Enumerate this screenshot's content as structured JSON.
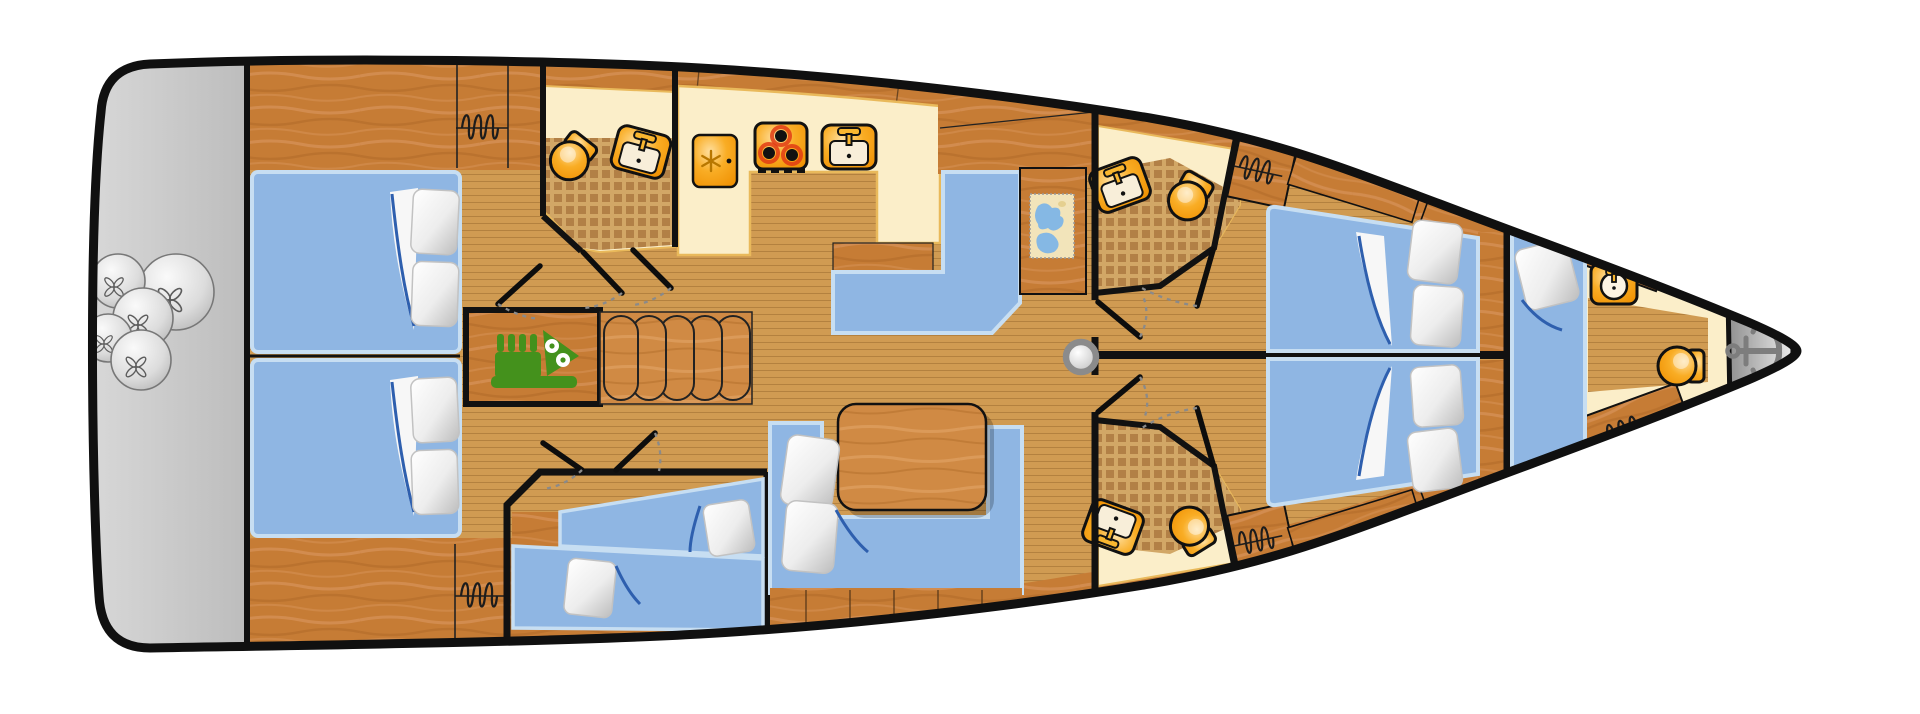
{
  "diagram": {
    "type": "yacht-interior-deck-plan",
    "orientation": "bow-right",
    "text_labels": []
  },
  "colors": {
    "background": "#ffffff",
    "hull_outline": "#101010",
    "platform_gray": "#c9c9c9",
    "wood_furniture": "#c67c35",
    "floor_plank": "#d09b52",
    "counter_cream": "#fbeec9",
    "bed_blue": "#8fb6e3",
    "fixture_orange": "#f6a41f",
    "engine_green": "#44911c",
    "anchor_gray": "#7d7d7d",
    "tile_checker": "#b28046"
  },
  "rooms": [
    {
      "id": "stern-platform",
      "name": "Stern swim platform",
      "fixtures": [
        "fender-ball x5"
      ]
    },
    {
      "id": "aft-cabin-port",
      "name": "Aft double cabin port",
      "fixtures": [
        "double-bed",
        "pillow x2",
        "wardrobe-coil"
      ]
    },
    {
      "id": "aft-cabin-starboard",
      "name": "Aft double cabin starboard",
      "fixtures": [
        "double-bed",
        "pillow x2",
        "wardrobe-coil"
      ]
    },
    {
      "id": "aft-head",
      "name": "Aft bathroom",
      "fixtures": [
        "toilet",
        "sink"
      ]
    },
    {
      "id": "galley",
      "name": "Galley",
      "fixtures": [
        "fridge",
        "stove-3-burner",
        "sink"
      ]
    },
    {
      "id": "engine-room",
      "name": "Engine compartment",
      "fixtures": [
        "engine"
      ]
    },
    {
      "id": "companionway",
      "name": "Companionway steps",
      "fixtures": [
        "step x5"
      ]
    },
    {
      "id": "nav-station",
      "name": "Chart table nav station",
      "fixtures": [
        "l-settee",
        "chart-desk",
        "sea-chart"
      ]
    },
    {
      "id": "salon",
      "name": "Salon",
      "fixtures": [
        "dining-table",
        "l-settee",
        "pillow x2"
      ]
    },
    {
      "id": "bunk-cabin",
      "name": "Mid single-berth cabin",
      "fixtures": [
        "single-bed x2",
        "pillow x2"
      ]
    },
    {
      "id": "mast",
      "name": "Mast base",
      "fixtures": [
        "mast"
      ]
    },
    {
      "id": "mid-head-port",
      "name": "Forward bathroom port",
      "fixtures": [
        "sink",
        "toilet"
      ]
    },
    {
      "id": "mid-head-starboard",
      "name": "Forward bathroom starboard",
      "fixtures": [
        "sink",
        "toilet"
      ]
    },
    {
      "id": "fwd-cabin-port",
      "name": "Forward double cabin port",
      "fixtures": [
        "double-bed",
        "pillow x2",
        "wardrobe-coil"
      ]
    },
    {
      "id": "fwd-cabin-starboard",
      "name": "Forward double cabin starboard",
      "fixtures": [
        "double-bed",
        "pillow x2",
        "wardrobe-coil"
      ]
    },
    {
      "id": "forepeak",
      "name": "Forepeak crew cabin",
      "fixtures": [
        "single-bed",
        "round-washbasin",
        "toilet",
        "wardrobe-coil"
      ]
    },
    {
      "id": "anchor-locker",
      "name": "Anchor locker",
      "fixtures": [
        "anchor"
      ]
    }
  ]
}
